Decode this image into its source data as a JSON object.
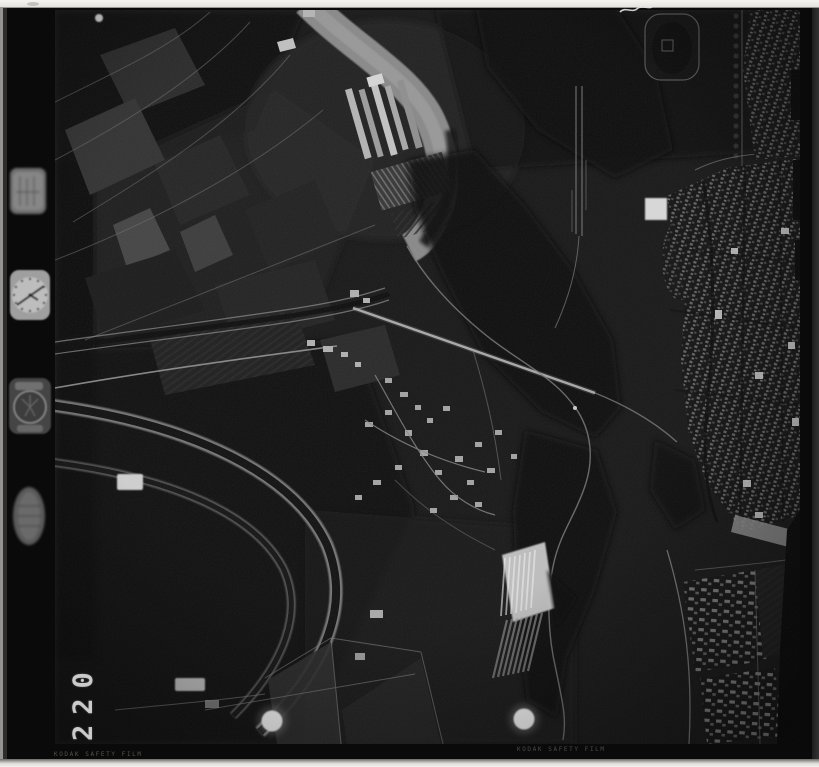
{
  "meta": {
    "description": "Black-and-white vertical aerial survey photograph on film: river valley with town on the right, farmland and greenhouses on the left, canal bends lower-left, railway and striped yard lower-centre, two white punch marks near the bottom."
  },
  "film_margin": {
    "frame_number": "220",
    "edge_print_left": "KODAK SAFETY FILM",
    "edge_print_right": "KODAK SAFETY FILM",
    "instrument_icons": [
      "data-panel-icon",
      "clock-dial-icon",
      "altimeter-dial-icon",
      "level-vial-icon"
    ]
  },
  "colors": {
    "page_background": "#f0eeea",
    "film_black": "#0a0a0a",
    "photo_base": "#191919",
    "river_gray": "#909090",
    "punch_hole_white": "#f2f2f2",
    "frame_number_gray": "#dedede",
    "edge_print_gray": "#585856"
  }
}
